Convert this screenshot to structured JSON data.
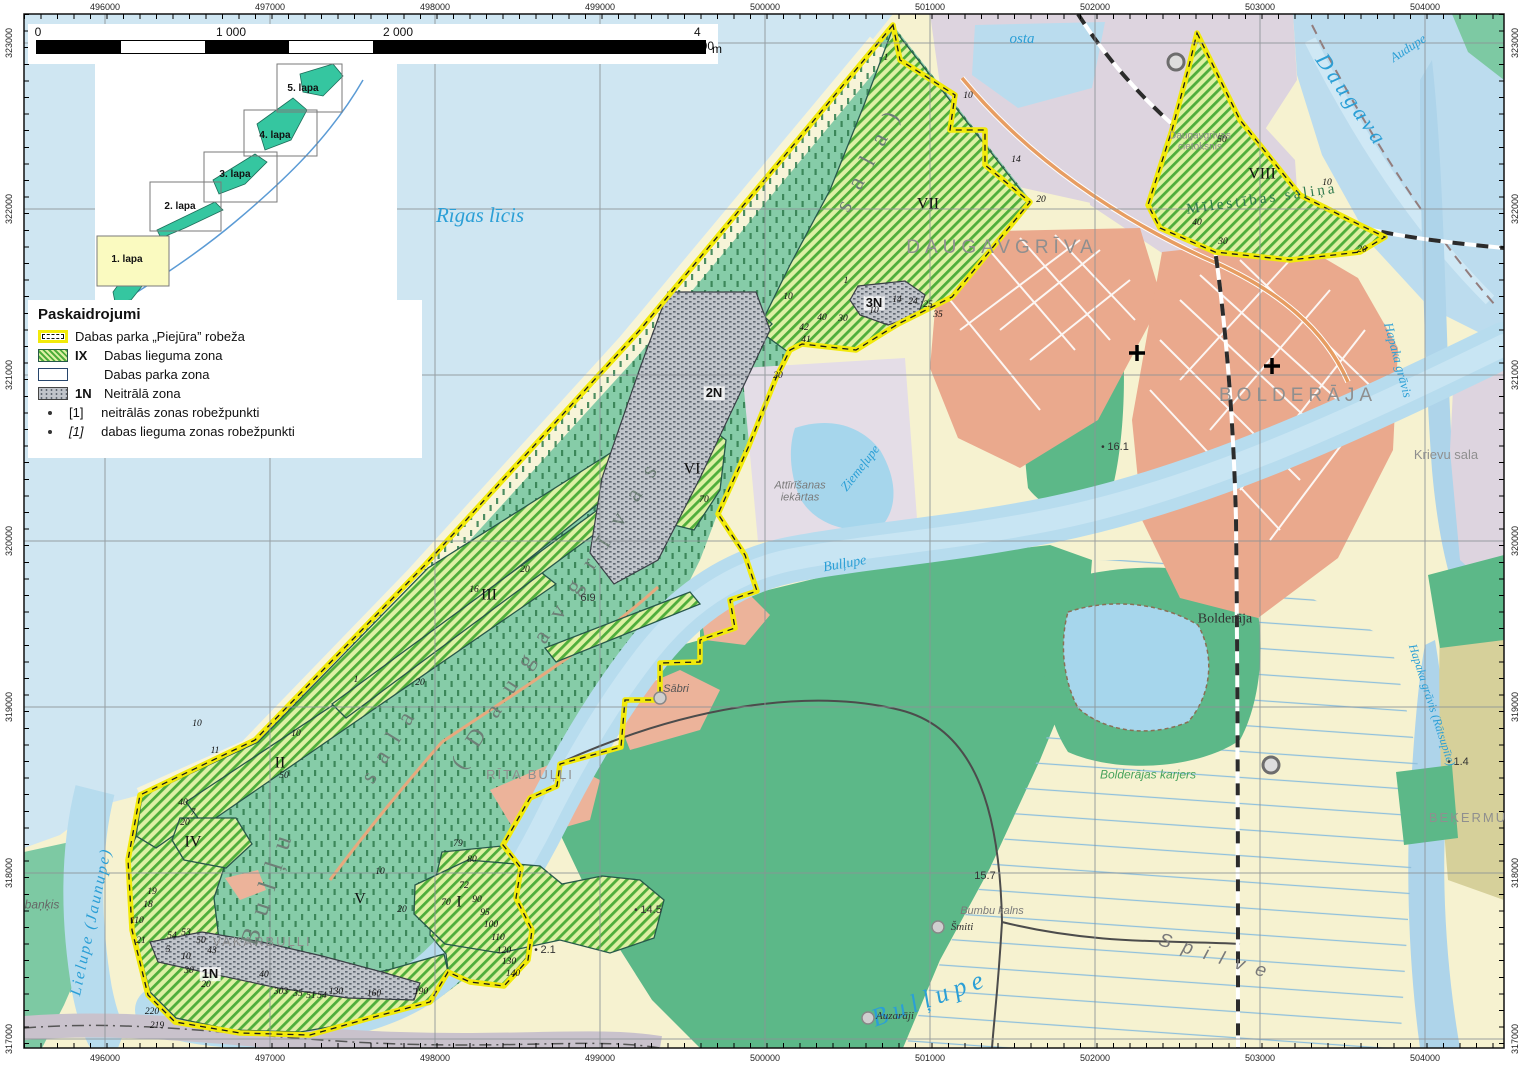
{
  "scale_bar": {
    "ticks": [
      "0",
      "1 000",
      "2 000",
      "4 000"
    ],
    "unit": "m"
  },
  "grid": {
    "top": [
      "496000",
      "497000",
      "498000",
      "499000",
      "500000",
      "501000",
      "502000",
      "503000",
      "504000"
    ],
    "bottom": [
      "496000",
      "497000",
      "498000",
      "499000",
      "500000",
      "501000",
      "502000",
      "503000",
      "504000"
    ],
    "left": [
      "323000",
      "322000",
      "321000",
      "320000",
      "319000",
      "318000",
      "317000"
    ],
    "right": [
      "323000",
      "322000",
      "321000",
      "320000",
      "319000",
      "318000",
      "317000"
    ]
  },
  "inset": {
    "sheets": [
      "1. lapa",
      "2. lapa",
      "3. lapa",
      "4. lapa",
      "5. lapa"
    ]
  },
  "legend": {
    "title": "Paskaidrojumi",
    "boundary": "Dabas parka „Piejūra” robeža",
    "lieguma_code": "IX",
    "lieguma": "Dabas lieguma zona",
    "parka": "Dabas parka zona",
    "neutral_code": "1N",
    "neutral": "Neitrālā zona",
    "pt1_code": "[1]",
    "pt1": "neitrālās zonas robežpunkti",
    "pt2_code": "[1]",
    "pt2": "dabas lieguma zonas robežpunkti"
  },
  "places": {
    "rigas_licis": "Rīgas līcis",
    "daugava": "Daugava",
    "audupe": "Audupe",
    "osta": "osta",
    "daugavgriva": "DAUGAVGRĪVA",
    "bolderaja": "BOLDERĀJA",
    "bolderaja_small": "Bolderāja",
    "bolderajas_karjers": "Bolderājas karjers",
    "krievu_sala": "Krievu sala",
    "hapaka_gravis": "Hapaka grāvis",
    "hapaka_gravis_ratsupite": "Hapaka grāvis (Rātsupīte)",
    "bekermuiza": "BEĶERMU",
    "ziemelupe": "Ziemeļupe",
    "attirisanas": "Attīrīšanas\niekārtas",
    "bullupe_small": "Bulļupe",
    "bullupe_large": "Bulļupe",
    "sabri": "Sābri",
    "rita_bulli": "RĪTA BUĻĻI",
    "vakarbulli": "VAKARBUĻĻI",
    "lielupe": "Lielupe (Jaunupe)",
    "bankis": "baņķis",
    "spilve": "Spilve",
    "smiti": "Šmiti",
    "auzaraji": "Auzarāji",
    "bumbu_kalns": "Bumbu kalns",
    "milestibas_salina": "Mīlestības saliņa",
    "cietoksnis": "Daugavgrīvas\ncietoksnis",
    "island_1": "Bulļu",
    "island_2": "sala",
    "island_3": "(Daugavgrīvas",
    "island_4": "sala)"
  },
  "zones": {
    "i": "I",
    "ii": "II",
    "iii": "III",
    "iv": "IV",
    "v": "V",
    "vi": "VI",
    "vii": "VII",
    "viii": "VIII",
    "n1": "1N",
    "n2": "2N",
    "n3": "3N"
  },
  "markers": [
    {
      "x": 968,
      "y": 96,
      "t": "10",
      "c": "pt"
    },
    {
      "x": 1016,
      "y": 160,
      "t": "14",
      "c": "pt"
    },
    {
      "x": 1041,
      "y": 200,
      "t": "20",
      "c": "pt"
    },
    {
      "x": 886,
      "y": 58,
      "t": "1",
      "c": "pt"
    },
    {
      "x": 846,
      "y": 281,
      "t": "1",
      "c": "pt"
    },
    {
      "x": 897,
      "y": 300,
      "t": "14",
      "c": "pt"
    },
    {
      "x": 913,
      "y": 302,
      "t": "24",
      "c": "pt"
    },
    {
      "x": 928,
      "y": 305,
      "t": "25",
      "c": "pt"
    },
    {
      "x": 874,
      "y": 311,
      "t": "10",
      "c": "pt"
    },
    {
      "x": 843,
      "y": 319,
      "t": "30",
      "c": "pt"
    },
    {
      "x": 822,
      "y": 318,
      "t": "40",
      "c": "pt"
    },
    {
      "x": 938,
      "y": 315,
      "t": "35",
      "c": "pt"
    },
    {
      "x": 804,
      "y": 328,
      "t": "42",
      "c": "pt"
    },
    {
      "x": 806,
      "y": 340,
      "t": "41",
      "c": "pt"
    },
    {
      "x": 788,
      "y": 297,
      "t": "10",
      "c": "pt"
    },
    {
      "x": 778,
      "y": 376,
      "t": "20",
      "c": "pt"
    },
    {
      "x": 704,
      "y": 500,
      "t": "70",
      "c": "pt"
    },
    {
      "x": 474,
      "y": 590,
      "t": "16",
      "c": "pt"
    },
    {
      "x": 525,
      "y": 570,
      "t": "20",
      "c": "pt"
    },
    {
      "x": 420,
      "y": 683,
      "t": "20",
      "c": "pt"
    },
    {
      "x": 356,
      "y": 680,
      "t": "1",
      "c": "pt"
    },
    {
      "x": 296,
      "y": 734,
      "t": "10",
      "c": "pt"
    },
    {
      "x": 284,
      "y": 776,
      "t": "50",
      "c": "pt"
    },
    {
      "x": 215,
      "y": 751,
      "t": "11",
      "c": "pt"
    },
    {
      "x": 197,
      "y": 724,
      "t": "10",
      "c": "pt"
    },
    {
      "x": 183,
      "y": 803,
      "t": "40",
      "c": "pt"
    },
    {
      "x": 185,
      "y": 823,
      "t": "20",
      "c": "pt"
    },
    {
      "x": 193,
      "y": 813,
      "t": "7",
      "c": "pt"
    },
    {
      "x": 380,
      "y": 872,
      "t": "10",
      "c": "pt"
    },
    {
      "x": 402,
      "y": 910,
      "t": "20",
      "c": "pt"
    },
    {
      "x": 458,
      "y": 844,
      "t": "79",
      "c": "pt"
    },
    {
      "x": 472,
      "y": 860,
      "t": "80",
      "c": "pt"
    },
    {
      "x": 464,
      "y": 886,
      "t": "72",
      "c": "pt"
    },
    {
      "x": 446,
      "y": 903,
      "t": "70",
      "c": "pt"
    },
    {
      "x": 477,
      "y": 900,
      "t": "90",
      "c": "pt"
    },
    {
      "x": 485,
      "y": 913,
      "t": "95",
      "c": "pt"
    },
    {
      "x": 491,
      "y": 925,
      "t": "100",
      "c": "pt"
    },
    {
      "x": 498,
      "y": 938,
      "t": "110",
      "c": "pt"
    },
    {
      "x": 504,
      "y": 951,
      "t": "120",
      "c": "pt"
    },
    {
      "x": 509,
      "y": 962,
      "t": "130",
      "c": "pt"
    },
    {
      "x": 513,
      "y": 974,
      "t": "140",
      "c": "pt"
    },
    {
      "x": 152,
      "y": 892,
      "t": "19",
      "c": "pt"
    },
    {
      "x": 148,
      "y": 905,
      "t": "18",
      "c": "pt"
    },
    {
      "x": 137,
      "y": 921,
      "t": "110",
      "c": "pt"
    },
    {
      "x": 141,
      "y": 941,
      "t": "21",
      "c": "pt"
    },
    {
      "x": 172,
      "y": 936,
      "t": "54",
      "c": "pt"
    },
    {
      "x": 186,
      "y": 933,
      "t": "53",
      "c": "pt"
    },
    {
      "x": 201,
      "y": 941,
      "t": "50",
      "c": "pt"
    },
    {
      "x": 168,
      "y": 950,
      "t": "5",
      "c": "pt"
    },
    {
      "x": 212,
      "y": 951,
      "t": "43",
      "c": "pt"
    },
    {
      "x": 186,
      "y": 957,
      "t": "10",
      "c": "pt"
    },
    {
      "x": 189,
      "y": 971,
      "t": "30",
      "c": "pt"
    },
    {
      "x": 206,
      "y": 985,
      "t": "20",
      "c": "pt"
    },
    {
      "x": 264,
      "y": 975,
      "t": "40",
      "c": "pt"
    },
    {
      "x": 281,
      "y": 992,
      "t": "303",
      "c": "pt"
    },
    {
      "x": 298,
      "y": 994,
      "t": "35",
      "c": "pt"
    },
    {
      "x": 311,
      "y": 996,
      "t": "51",
      "c": "pt"
    },
    {
      "x": 322,
      "y": 996,
      "t": "54",
      "c": "pt"
    },
    {
      "x": 336,
      "y": 992,
      "t": "130",
      "c": "pt"
    },
    {
      "x": 374,
      "y": 994,
      "t": "160",
      "c": "pt"
    },
    {
      "x": 421,
      "y": 992,
      "t": "190",
      "c": "pt"
    },
    {
      "x": 152,
      "y": 1012,
      "t": "220",
      "c": "pt"
    },
    {
      "x": 157,
      "y": 1026,
      "t": "219",
      "c": "pt"
    },
    {
      "x": 1222,
      "y": 140,
      "t": "50",
      "c": "pt"
    },
    {
      "x": 1327,
      "y": 183,
      "t": "10",
      "c": "pt"
    },
    {
      "x": 1197,
      "y": 223,
      "t": "40",
      "c": "pt"
    },
    {
      "x": 1223,
      "y": 242,
      "t": "30",
      "c": "pt"
    },
    {
      "x": 1362,
      "y": 250,
      "t": "20",
      "c": "pt"
    },
    {
      "x": 1115,
      "y": 447,
      "t": "16.1",
      "c": "elev"
    },
    {
      "x": 648,
      "y": 910,
      "t": "14.5",
      "c": "elev"
    },
    {
      "x": 545,
      "y": 950,
      "t": "2.1",
      "c": "elev"
    },
    {
      "x": 1458,
      "y": 762,
      "t": "1.4",
      "c": "elev"
    },
    {
      "x": 588,
      "y": 598,
      "t": "6.9",
      "c": "elev2"
    },
    {
      "x": 985,
      "y": 876,
      "t": "15.7",
      "c": "elev2"
    }
  ],
  "colors": {
    "sea": "#cfe6f2",
    "river": "#b7dcee",
    "sand": "#f6f2d0",
    "park_teal": "#86cca8",
    "forest": "#5cb888",
    "lieguma_stripe": "#4fae3b",
    "neutral": "#c0c4ca",
    "urban": "#eaa98d",
    "built_gray": "#ddd4df",
    "boundary_yellow": "#f2ea0a"
  }
}
